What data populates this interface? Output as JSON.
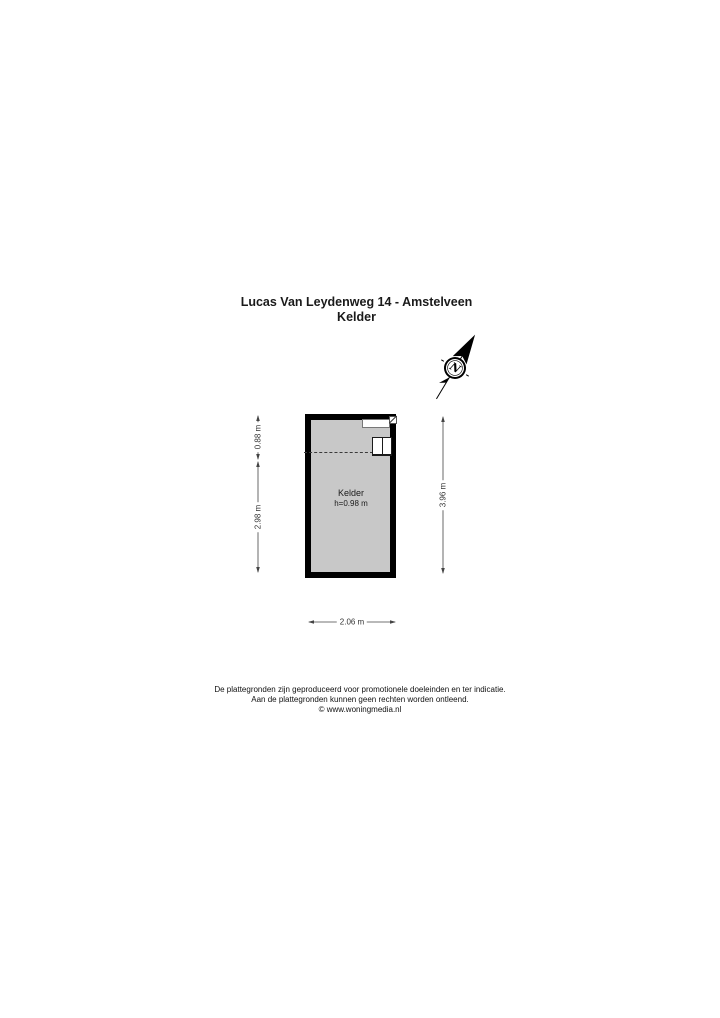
{
  "title": {
    "line1": "Lucas Van Leydenweg 14 - Amstelveen",
    "line2": "Kelder"
  },
  "compass": {
    "label": "N"
  },
  "floorplan": {
    "room": {
      "name": "Kelder",
      "height_label": "h=0.98 m"
    },
    "colors": {
      "wall": "#000000",
      "floor": "#c8c8c8",
      "background": "#ffffff"
    }
  },
  "dimensions": {
    "left_top": "0.88 m",
    "left_bottom": "2.98 m",
    "right": "3.96 m",
    "bottom": "2.06 m"
  },
  "footer": {
    "line1": "De plattegronden zijn geproduceerd voor promotionele doeleinden en ter indicatie.",
    "line2": "Aan de plattegronden kunnen geen rechten worden ontleend.",
    "line3": "© www.woningmedia.nl"
  }
}
